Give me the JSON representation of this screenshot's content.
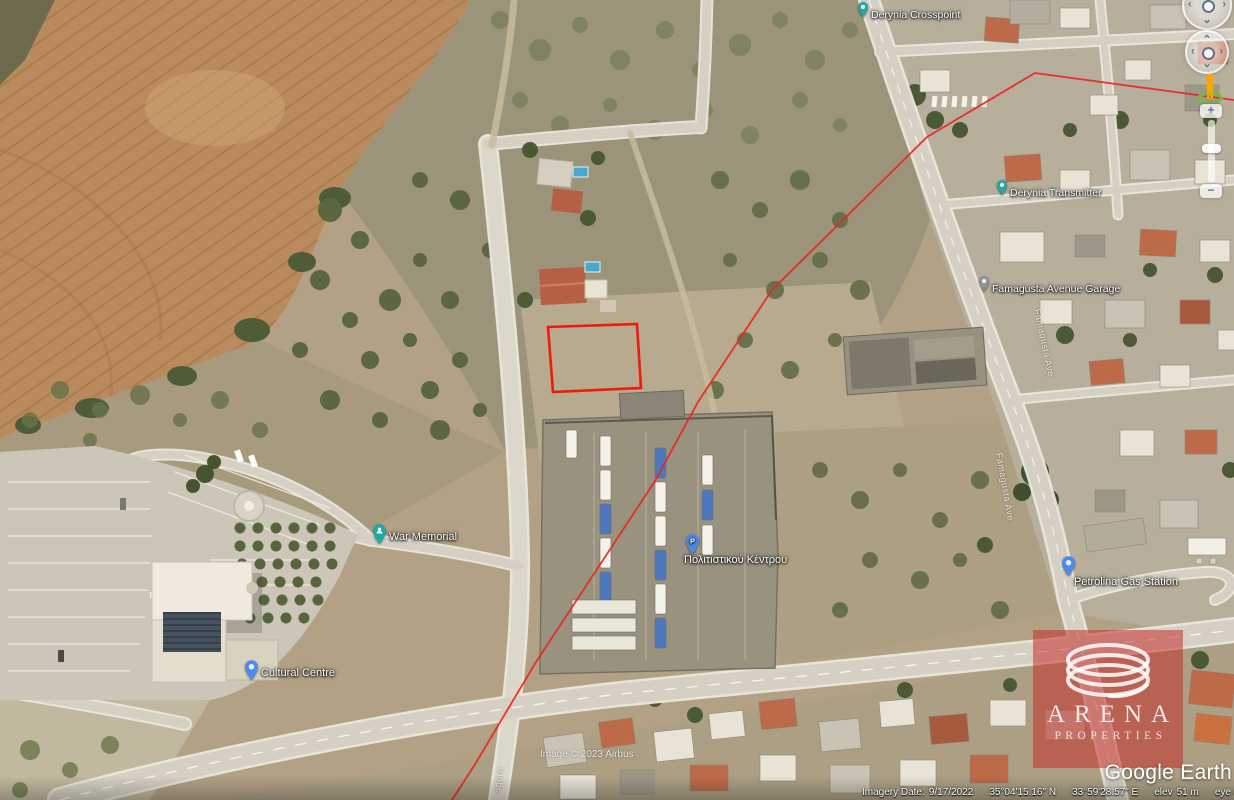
{
  "app": {
    "name": "Google Earth"
  },
  "colors": {
    "annotation_red": "#e81a10",
    "label_text": "#ffffff",
    "arena_overlay_red": "#c5302c",
    "pin_teal": "#2aa5a0",
    "pin_blue": "#4d8af0",
    "pin_gray": "#8d9298"
  },
  "map_labels": [
    {
      "text": "Derynia Crosspoint",
      "icon": "teal-dot-pin"
    },
    {
      "text": "Derynia Transmitter",
      "icon": "teal-pin"
    },
    {
      "text": "Famagusta Avenue Garage",
      "icon": "gray-pin"
    },
    {
      "text": "War Memorial",
      "icon": "teal-person-pin"
    },
    {
      "text": "Cultural Centre",
      "icon": "blue-pin"
    },
    {
      "text": "Πολιτιστικού Κέντρου",
      "icon": "blue-parking-pin",
      "pin_letter": "P"
    },
    {
      "text": "Petrolina Gas Station",
      "icon": "blue-pin"
    }
  ],
  "street_labels": [
    {
      "text": "Famagusta Ave"
    },
    {
      "text": "Famagusta Ave"
    },
    {
      "text": "agora"
    }
  ],
  "annotations": {
    "plot_outline": "red rectangle marking property plot",
    "boundary_line": "red boundary line crossing map"
  },
  "watermarks": {
    "imagery_credit": "Image © 2023 Airbus",
    "arena": {
      "name": "ARENA",
      "subtitle": "PROPERTIES"
    },
    "google_earth": "Google Earth"
  },
  "status_bar": {
    "imagery_date_label": "Imagery Date:",
    "imagery_date": "9/17/2022",
    "latitude": "35°04'15.16\" N",
    "longitude": "33°59'28.57\" E",
    "elevation_label": "elev",
    "elevation": "51 m",
    "eye_alt_label": "eye alt",
    "eye_alt": "796 m"
  },
  "controls": {
    "look_left": "‹",
    "look_right": "›",
    "look_down": "⌄",
    "look_up": "⌃",
    "zoom_in": "+",
    "zoom_out": "−"
  }
}
